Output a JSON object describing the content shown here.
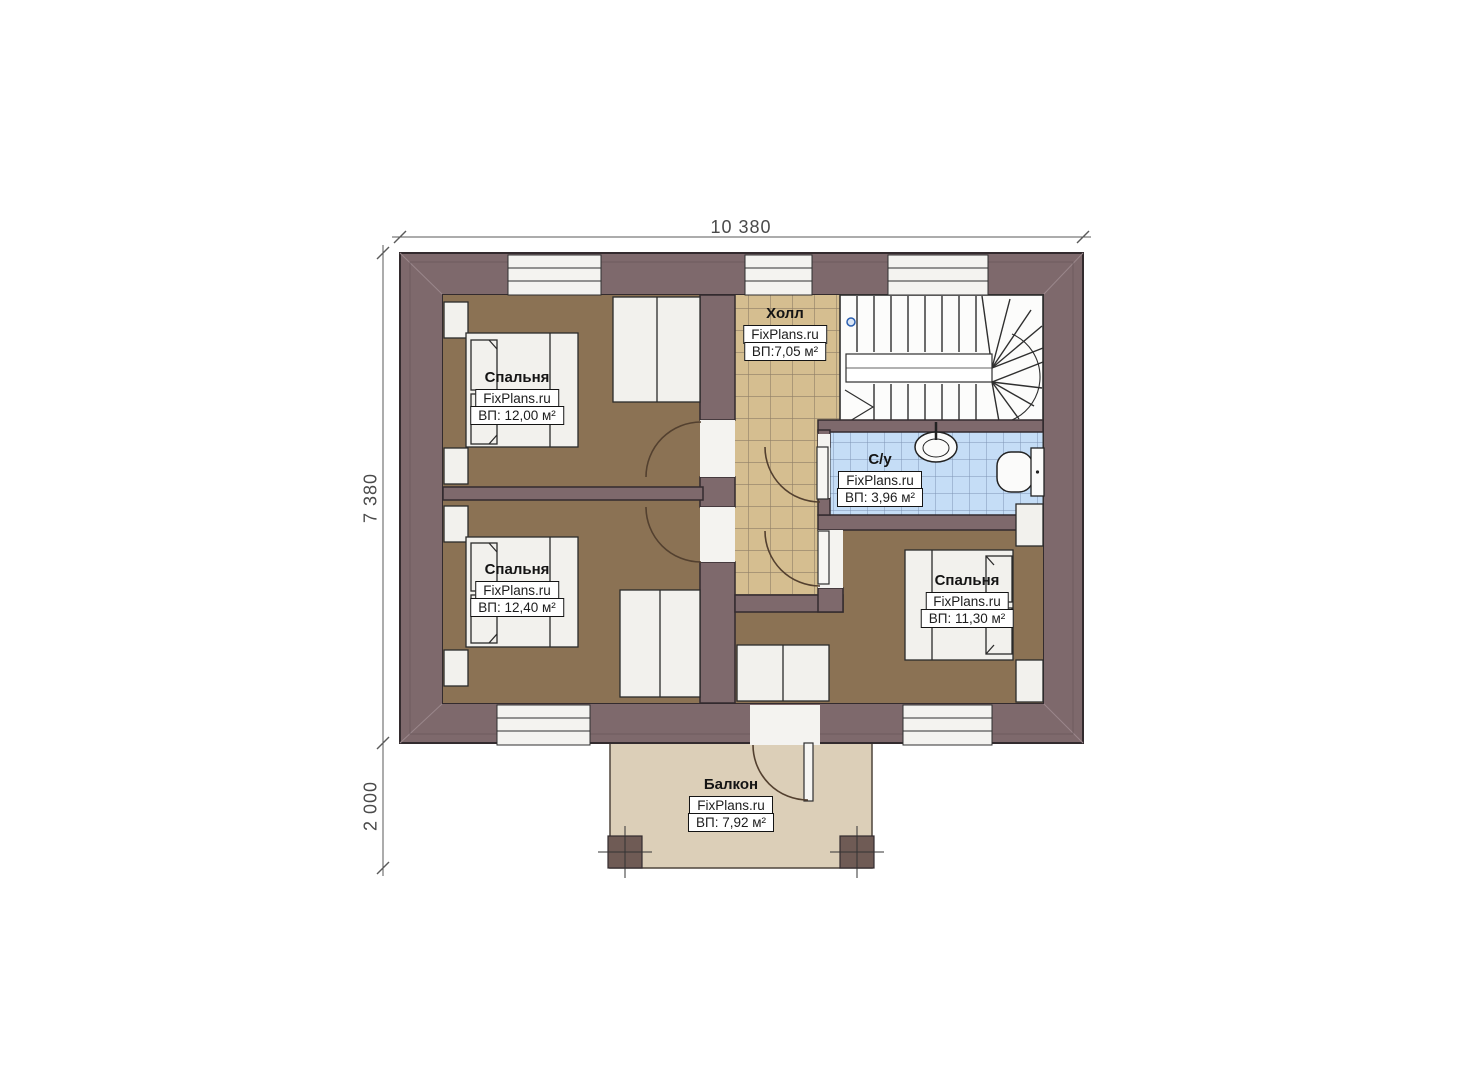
{
  "watermark": "FixPlans.ru",
  "dimensions": {
    "width_total": "10 380",
    "height_main": "7 380",
    "height_balcony": "2 000"
  },
  "rooms": [
    {
      "id": "bedroom-1",
      "name": "Спальня",
      "area": "ВП: 12,00 м²"
    },
    {
      "id": "bedroom-2",
      "name": "Спальня",
      "area": "ВП: 12,40 м²"
    },
    {
      "id": "bedroom-3",
      "name": "Спальня",
      "area": "ВП: 11,30 м²"
    },
    {
      "id": "hall",
      "name": "Холл",
      "area": "ВП:7,05 м²"
    },
    {
      "id": "bathroom",
      "name": "С/у",
      "area": "ВП: 3,96 м²"
    },
    {
      "id": "balcony",
      "name": "Балкон",
      "area": "ВП: 7,92 м²"
    }
  ],
  "colors": {
    "wall": "#7e696c",
    "wall_outline": "#332b2e",
    "bedroom_floor": "#8b7254",
    "hall_tile": "#d5be90",
    "hall_tile_line": "#8f7e66",
    "bath_tile": "#c5ddf6",
    "bath_tile_line": "#7e95b5",
    "balcony_floor": "#dccfb8",
    "furniture": "#f2f1ed",
    "dimension_text": "#4a4a4a"
  }
}
